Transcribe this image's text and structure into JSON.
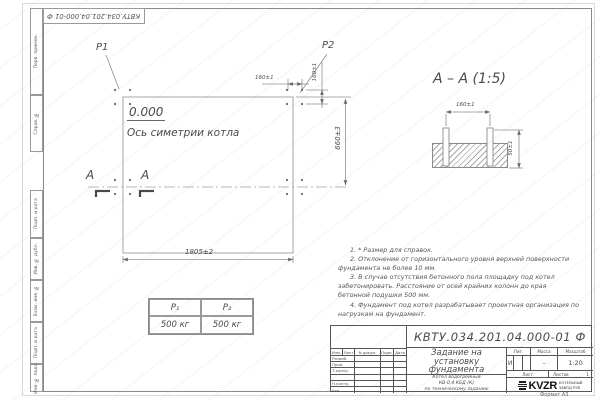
{
  "page": {
    "doc_number_top": "КВТУ.034.201.04.000-01 Ф",
    "format_label": "Формат А3"
  },
  "frame_stamps": {
    "perv_primen": "Перв. примен.",
    "sprav_no": "Справ. №",
    "podp_data_1": "Подп. и дата",
    "inv_dubl": "Инв. № дубл.",
    "vzam_inv": "Взам. инв. №",
    "podp_data_2": "Подп. и дата",
    "inv_podl": "Инв. № подл."
  },
  "plan": {
    "p1_label": "P1",
    "p2_label": "P2",
    "elevation": "0.000",
    "axis_label": "Ось симетрии котла",
    "dim_width": "1805±2",
    "dim_height": "660±3",
    "dim_bolt_h": "160±1",
    "dim_bolt_v": "160±1",
    "section_letter": "А"
  },
  "section": {
    "title": "А – А (1:5)",
    "dim_spacing": "160±1",
    "dim_embed": "50±1"
  },
  "notes": [
    "1. * Размер для справок.",
    "2. Отклонение от горизонтального уровня верхней поверхности фундамента не более 10 мм.",
    "3. В случае отсутствия бетонного пола площадку под котел забетонировать. Расстояние от осей крайних колонн до края бетонной подушки 500 мм.",
    "4. Фундамент под котел разрабатывает проектная организация по нагрузкам на фундамент."
  ],
  "loads_table": {
    "headers": [
      "P₁",
      "P₂"
    ],
    "values": [
      "500 кг",
      "500 кг"
    ]
  },
  "title_block": {
    "doc_number": "КВТУ.034.201.04.000-01 Ф",
    "title_lines": [
      "Задание на",
      "установку",
      "фундамента"
    ],
    "product_lines": [
      "Котел водогрейный",
      "КВ-0,4 КБД (К)",
      "по техническому заданию"
    ],
    "sig_header": [
      "Изм.",
      "Лист",
      "N докум.",
      "Подп.",
      "Дата"
    ],
    "sig_rows": [
      "Разраб.",
      "Пров.",
      "Т.контр.",
      "",
      "Н.контр.",
      "Утв."
    ],
    "lit_label": "Лит.",
    "lit_value": "И",
    "mass_label": "Масса",
    "mass_value": "–",
    "scale_label": "Масштаб",
    "scale_value": "1:20",
    "sheet_label": "Лист",
    "sheets_label": "Листов",
    "sheets_value": "1",
    "logo_text": "KVZR",
    "logo_caption_1": "КОТЕЛЬНЫЙ",
    "logo_caption_2": "ЗАВОД РЭП"
  }
}
